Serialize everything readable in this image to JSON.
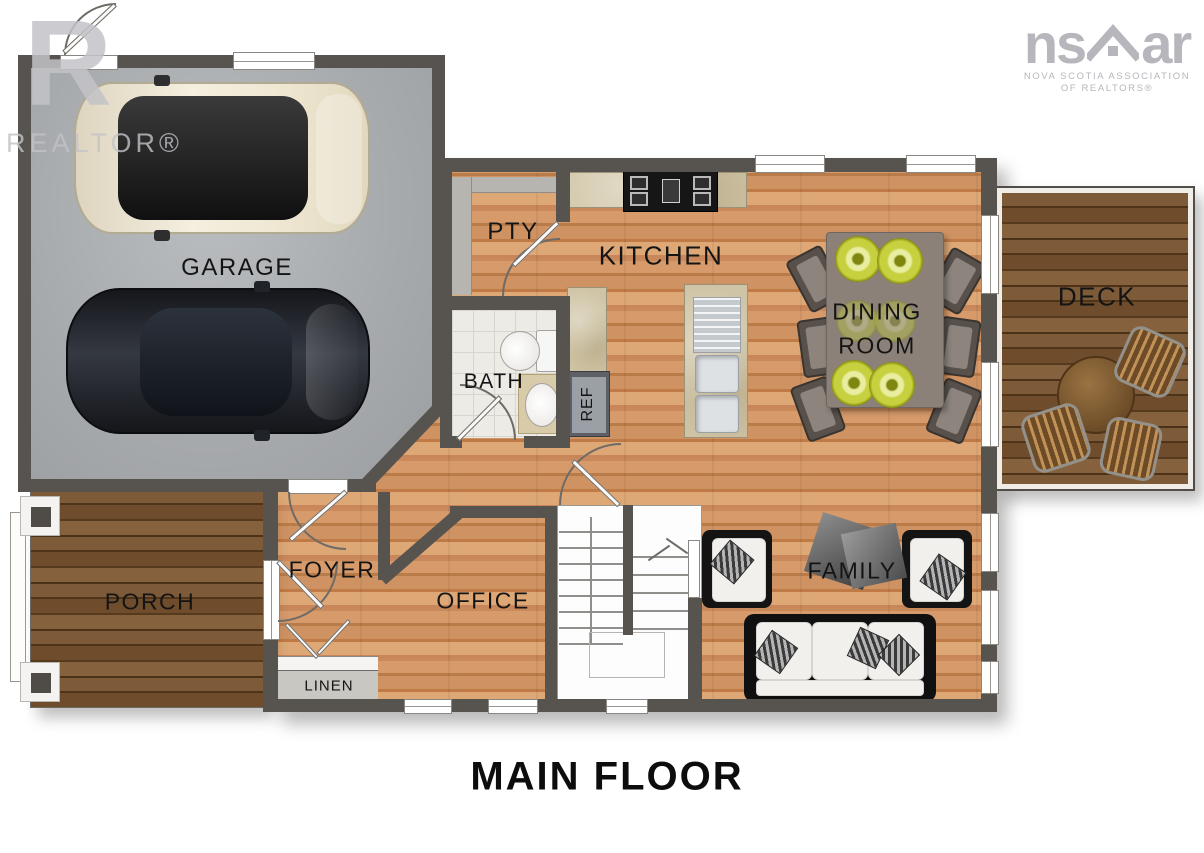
{
  "title": "MAIN FLOOR",
  "watermark": {
    "letter": "R",
    "label": "REALTOR®"
  },
  "brand": {
    "prefix": "ns",
    "suffix": "ar",
    "line1": "NOVA SCOTIA ASSOCIATION",
    "line2": "OF REALTORS®"
  },
  "rooms": {
    "garage": "GARAGE",
    "pantry": "PTY",
    "kitchen": "KITCHEN",
    "dining1": "DINING",
    "dining2": "ROOM",
    "deck": "DECK",
    "bath": "BATH",
    "fridge": "REF",
    "foyer": "FOYER",
    "office": "OFFICE",
    "porch": "PORCH",
    "linen": "LINEN",
    "family": "FAMILY"
  },
  "colors": {
    "wall": "#57534e",
    "wood_light": "#d79a6a",
    "wood_mid": "#c9895a",
    "wood_dark": "#b97c49",
    "deck_light": "#7d5a38",
    "deck_dark": "#553a1e",
    "concrete": "#a7aaad",
    "counter": "#cfc4a5",
    "plate_green": "#c7d13f",
    "label": "#141414",
    "watermark": "#c3c3c8"
  }
}
